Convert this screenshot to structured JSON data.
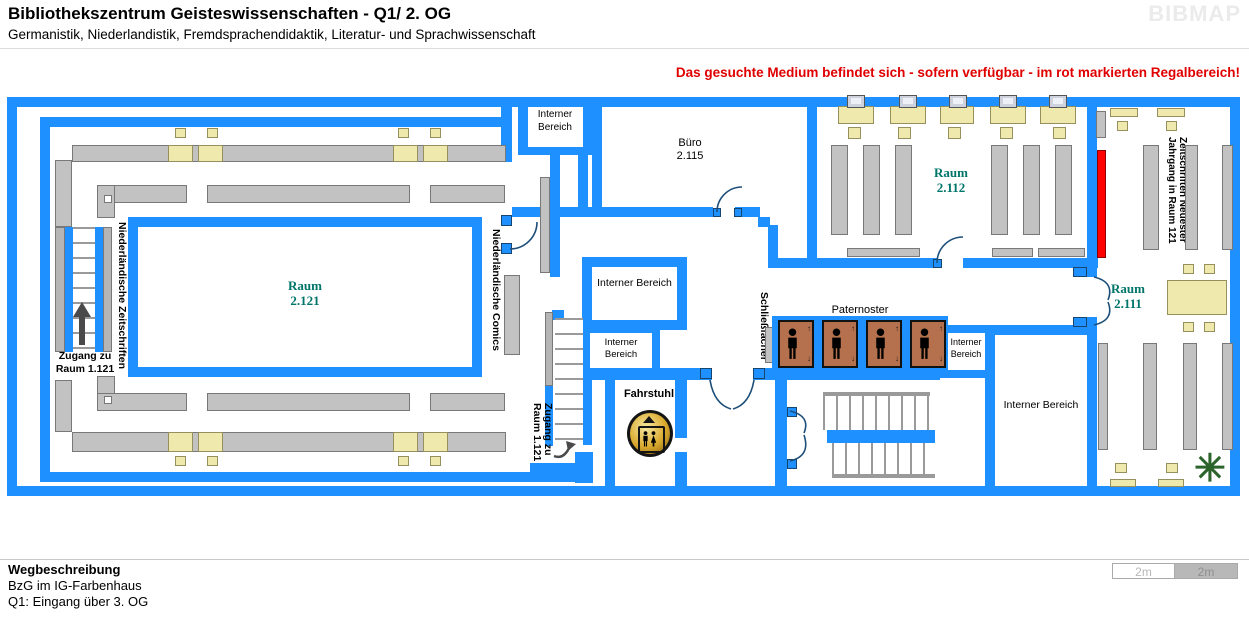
{
  "header": {
    "title": "Bibliothekszentrum Geisteswissenschaften - Q1/ 2. OG",
    "subtitle": "Germanistik, Niederlandistik, Fremdsprachendidaktik, Literatur- und Sprachwissenschaft",
    "logo": "BIBMAP"
  },
  "notice": "Das gesuchte Medium befindet sich - sofern verfügbar -  im rot markierten Regalbereich!",
  "rooms": {
    "r2121": {
      "name": "Raum",
      "number": "2.121"
    },
    "buero": {
      "name": "Büro",
      "number": "2.115"
    },
    "r2112": {
      "name": "Raum",
      "number": "2.112"
    },
    "r2111": {
      "name": "Raum",
      "number": "2.111"
    }
  },
  "labels": {
    "interner_bereich": "Interner Bereich",
    "paternoster": "Paternoster",
    "fahrstuhl": "Fahrstuhl",
    "schliessfaecher": "Schließfächer",
    "zugang_line1": "Zugang zu",
    "zugang_line2": "Raum 1.121",
    "niederl_zeitschriften": "Niederländische Zeitschriften",
    "niederl_comics": "Niederländische Comics",
    "zeitschriften_line1": "Zeitschriften Neuester",
    "zeitschriften_line2": "Jahrgang in Raum 121"
  },
  "footer": {
    "heading": "Wegbeschreibung",
    "line1": "BzG im IG-Farbenhaus",
    "line2": "Q1: Eingang über 3. OG"
  },
  "scale": {
    "left": "2m",
    "right": "2m"
  },
  "colors": {
    "wall": "#1E90FF",
    "highlight_shelf": "#FF0000",
    "room_label": "#00756A",
    "shelf": "#C2C2C2",
    "furniture": "#EFE9AE",
    "paternoster_cell": "#B5714E"
  }
}
